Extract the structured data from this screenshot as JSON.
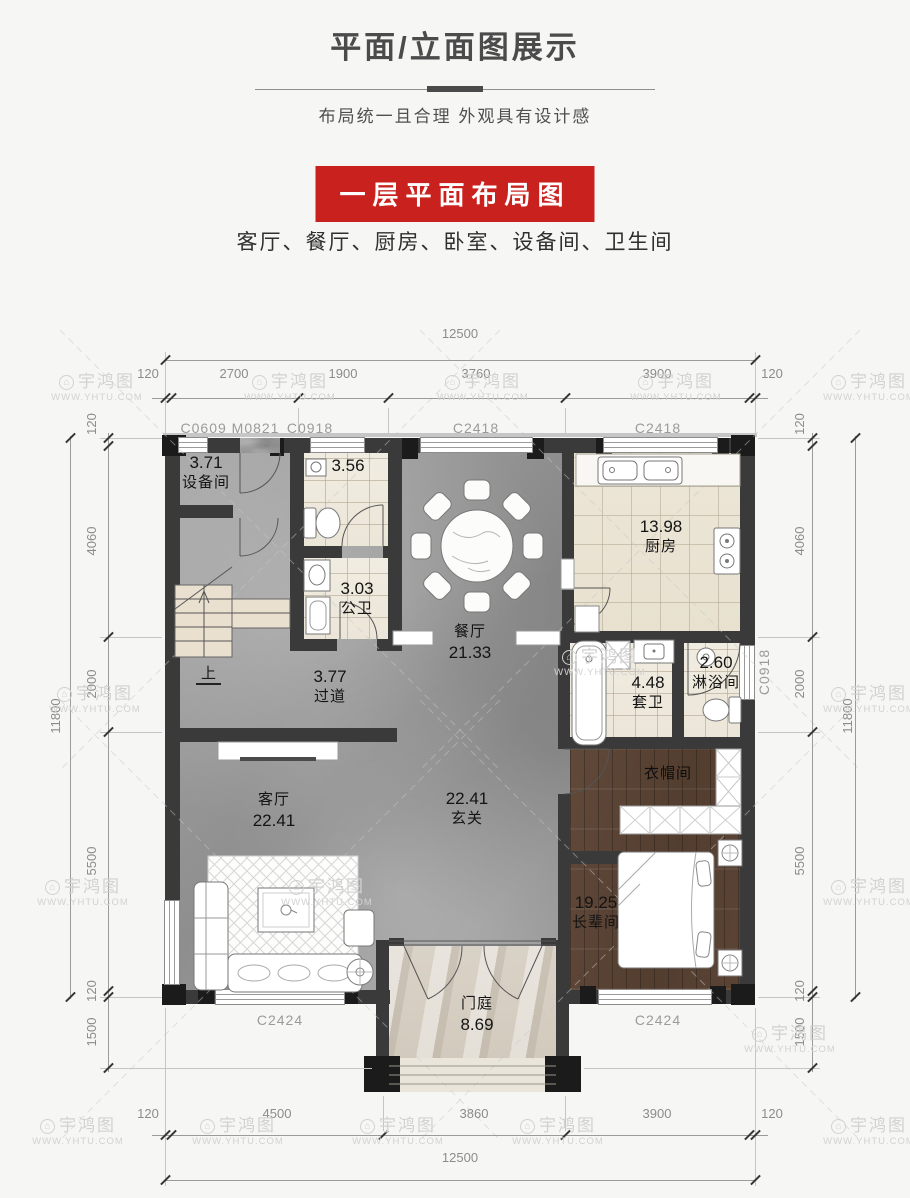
{
  "header": {
    "title": "平面/立面图展示",
    "subtitle": "布局统一且合理 外观具有设计感",
    "banner_label": "一层平面布局图",
    "rooms_line": "客厅、餐厅、厨房、卧室、设备间、卫生间"
  },
  "watermark": {
    "brand": "宇鸿图",
    "site": "WWW.YHTU.COM",
    "logo_glyph": "⌂"
  },
  "colors": {
    "banner_red": "#c9211e",
    "wall": "#3a3a3a",
    "wood_floor": "#5a4434",
    "marble_gray": "#9b9b9b"
  },
  "plan": {
    "stairs_up": "上",
    "rooms": {
      "shebeijian": {
        "num": "3.71",
        "name": "设备间"
      },
      "wc356": {
        "num": "3.56"
      },
      "gongwei": {
        "num": "3.03",
        "name": "公卫"
      },
      "canting": {
        "name": "餐厅",
        "num": "21.33"
      },
      "chufang": {
        "num": "13.98",
        "name": "厨房"
      },
      "taowei": {
        "num": "4.48",
        "name": "套卫"
      },
      "linyu": {
        "num": "2.60",
        "name": "淋浴间"
      },
      "guodao": {
        "num": "3.77",
        "name": "过道"
      },
      "keting": {
        "name": "客厅",
        "num": "22.41"
      },
      "xuanguan": {
        "num": "22.41",
        "name": "玄关"
      },
      "yimao": {
        "name": "衣帽间"
      },
      "zhangbei": {
        "num": "19.25",
        "name": "长辈间"
      },
      "menting": {
        "name": "门庭",
        "num": "8.69"
      }
    },
    "windows": {
      "top1": "C0609 M0821",
      "top2": "C0918",
      "top3": "C2418",
      "top4": "C2418",
      "right1": "C0918",
      "bottom1": "C2424",
      "bottom2": "C2424"
    },
    "dims": {
      "top_total": "12500",
      "top": [
        "120",
        "2700",
        "1900",
        "3760",
        "3900",
        "120"
      ],
      "bottom": [
        "120",
        "4500",
        "3860",
        "3900",
        "120"
      ],
      "bottom_total": "12500",
      "left": [
        "120",
        "4060",
        "2000",
        "5500",
        "120",
        "1500"
      ],
      "left_total": "11800",
      "right": [
        "120",
        "4060",
        "2000",
        "5500",
        "120",
        "1500"
      ],
      "right_total": "11800"
    }
  }
}
